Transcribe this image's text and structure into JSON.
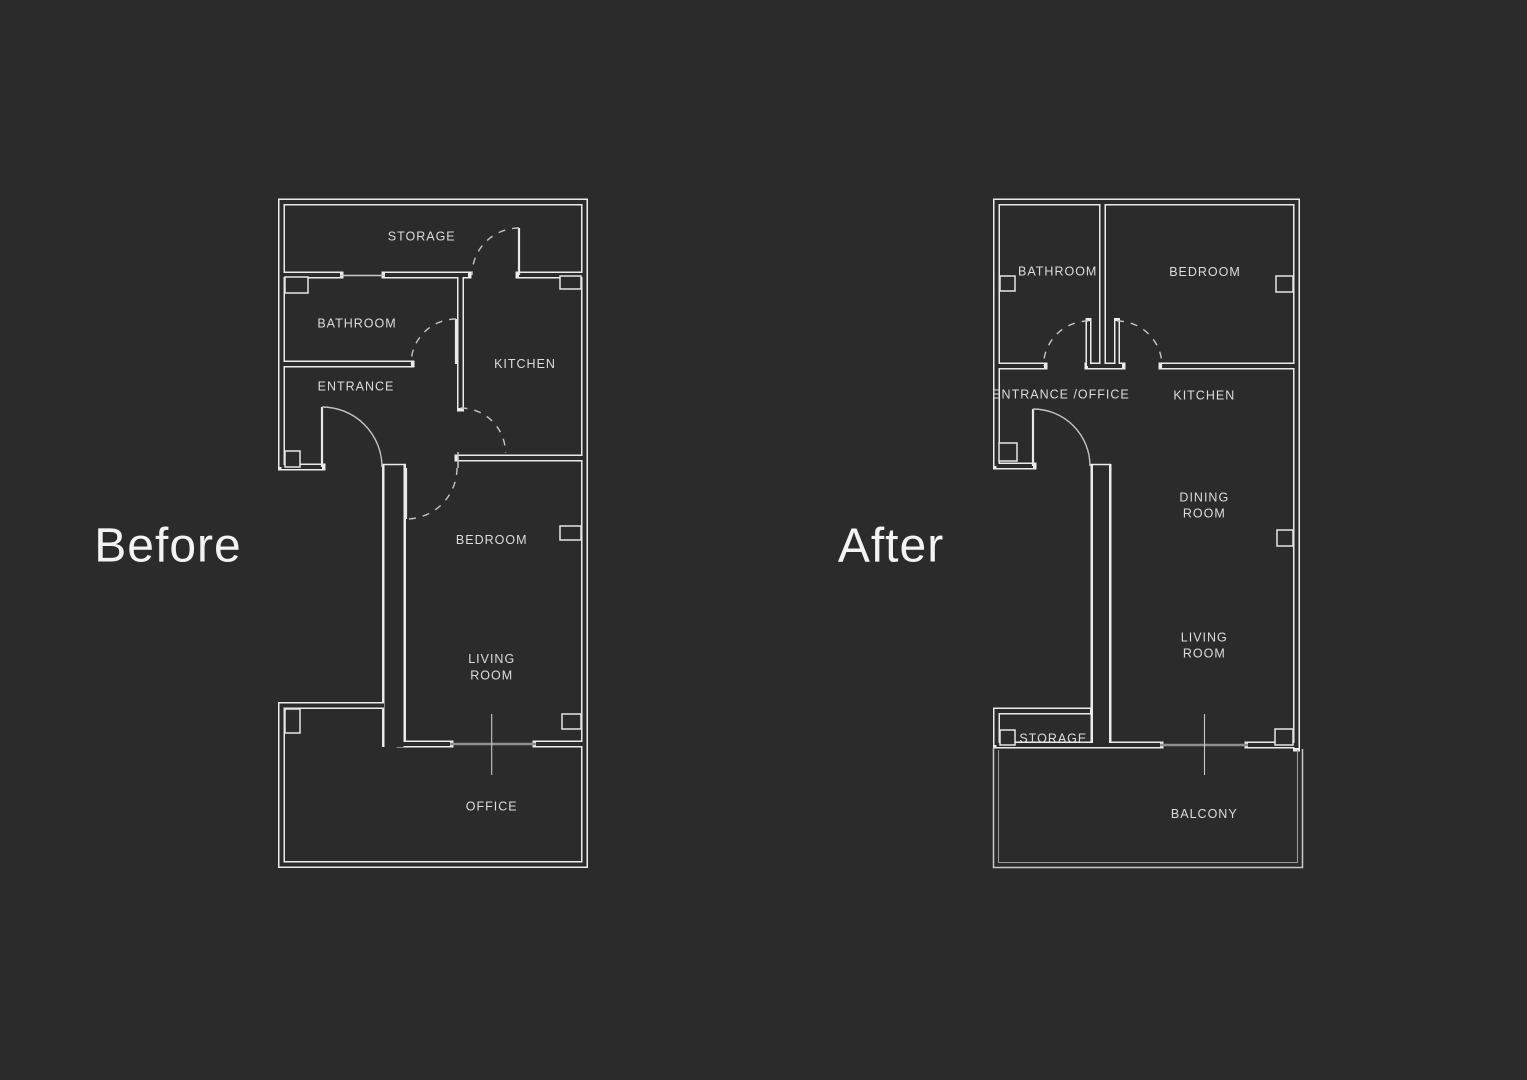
{
  "colors": {
    "background": "#2b2b2b",
    "wall_line": "#ebebeb",
    "thin_line": "#c9c9c9",
    "slider_line": "#8f8f8f",
    "label_text": "#dcdcdc",
    "heading_text": "#f3f3f3"
  },
  "plans": {
    "before": {
      "title": "Before",
      "rooms": [
        {
          "name": "storage",
          "lines": [
            "STORAGE"
          ]
        },
        {
          "name": "bathroom",
          "lines": [
            "BATHROOM"
          ]
        },
        {
          "name": "entrance",
          "lines": [
            "ENTRANCE"
          ]
        },
        {
          "name": "kitchen",
          "lines": [
            "KITCHEN"
          ]
        },
        {
          "name": "bedroom",
          "lines": [
            "BEDROOM"
          ]
        },
        {
          "name": "living-room",
          "lines": [
            "LIVING",
            "ROOM"
          ]
        },
        {
          "name": "office",
          "lines": [
            "OFFICE"
          ]
        }
      ]
    },
    "after": {
      "title": "After",
      "rooms": [
        {
          "name": "bathroom",
          "lines": [
            "BATHROOM"
          ]
        },
        {
          "name": "bedroom",
          "lines": [
            "BEDROOM"
          ]
        },
        {
          "name": "entrance-office",
          "lines": [
            "ENTRANCE /OFFICE"
          ]
        },
        {
          "name": "kitchen",
          "lines": [
            "KITCHEN"
          ]
        },
        {
          "name": "dining-room",
          "lines": [
            "DINING",
            "ROOM"
          ]
        },
        {
          "name": "living-room",
          "lines": [
            "LIVING",
            "ROOM"
          ]
        },
        {
          "name": "storage",
          "lines": [
            "STORAGE"
          ]
        },
        {
          "name": "balcony",
          "lines": [
            "BALCONY"
          ]
        }
      ]
    }
  }
}
